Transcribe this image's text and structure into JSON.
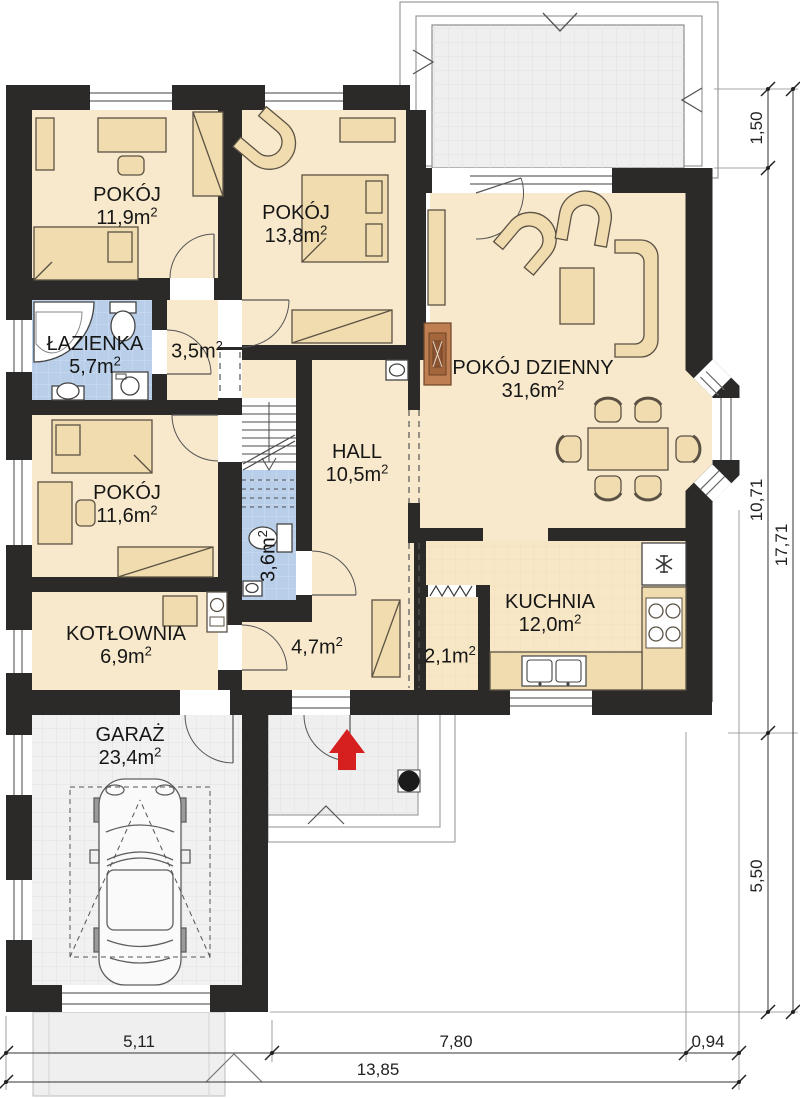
{
  "plan": {
    "rooms": [
      {
        "name": "POKÓJ",
        "area": "11,9m²"
      },
      {
        "name": "POKÓJ",
        "area": "13,8m²"
      },
      {
        "name": "ŁAZIENKA",
        "area": "5,7m²"
      },
      {
        "name": "",
        "area": "3,5m²"
      },
      {
        "name": "POKÓJ DZIENNY",
        "area": "31,6m²"
      },
      {
        "name": "HALL",
        "area": "10,5m²"
      },
      {
        "name": "POKÓJ",
        "area": "11,6m²"
      },
      {
        "name": "",
        "area": "3,6m²"
      },
      {
        "name": "KOTŁOWNIA",
        "area": "6,9m²"
      },
      {
        "name": "",
        "area": "4,7m²"
      },
      {
        "name": "",
        "area": "2,1m²"
      },
      {
        "name": "KUCHNIA",
        "area": "12,0m²"
      },
      {
        "name": "GARAŻ",
        "area": "23,4m²"
      }
    ],
    "dimensions": {
      "right": [
        "1,50",
        "10,71",
        "5,50",
        "17,71"
      ],
      "bottom": [
        "5,11",
        "7,80",
        "0,94",
        "13,85"
      ]
    },
    "colors": {
      "wall": "#2b2a29",
      "floor": "#f8e9cc",
      "bathroom": "#b9cee9",
      "furniture": "#f0dcae",
      "fireplace": "#bf7f52",
      "paving": "#eeeeee",
      "entrance_arrow": "#d61f1f"
    },
    "icons": {
      "entrance_arrow_icon": "red up arrow at main entrance",
      "stairs_direction_icon": "stair direction arrow",
      "fridge_snowflake_icon": "snowflake (fridge)",
      "cooktop_icon": "4 burner rings",
      "porch_column_icon": "black round column"
    }
  }
}
